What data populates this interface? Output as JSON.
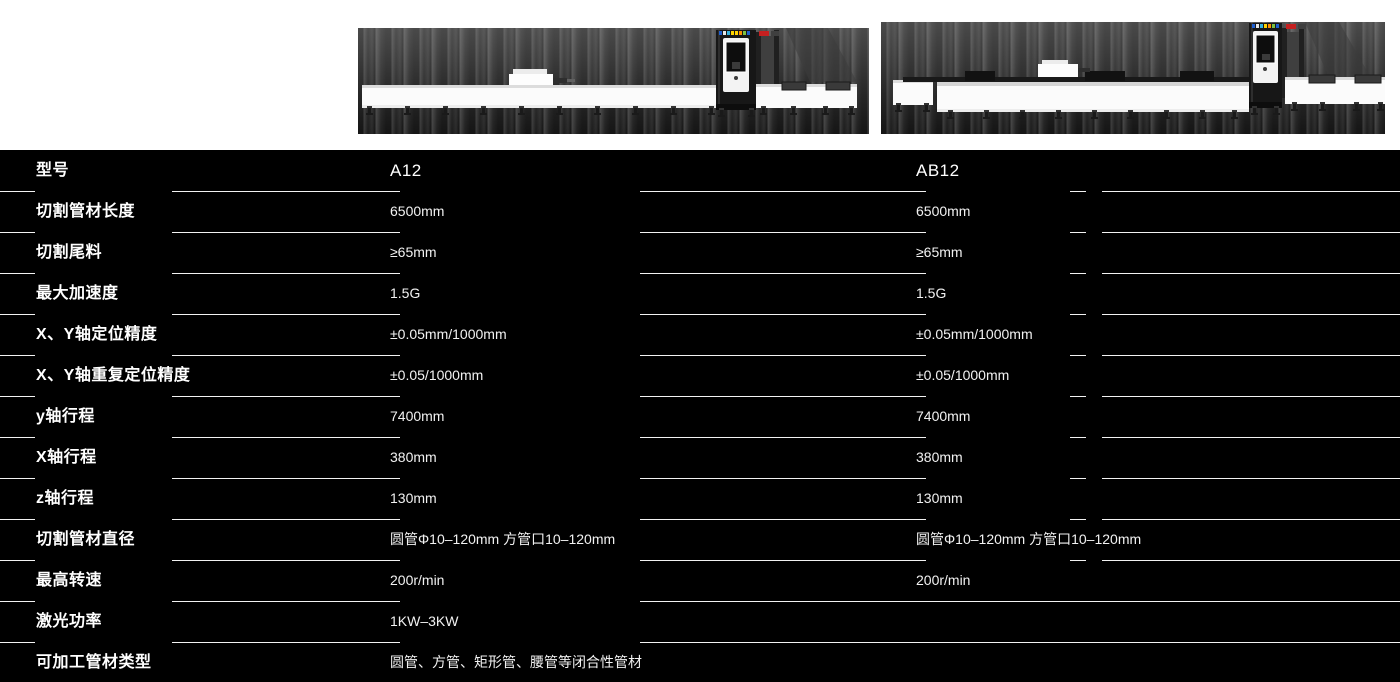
{
  "products": {
    "left_model": "A12",
    "right_model": "AB12"
  },
  "spec_table": {
    "header": {
      "label": "型号",
      "values": [
        "A12",
        "AB12"
      ]
    },
    "rows": [
      {
        "label": "切割管材长度",
        "values": [
          "6500mm",
          "6500mm"
        ]
      },
      {
        "label": "切割尾料",
        "values": [
          "≥65mm",
          "≥65mm"
        ]
      },
      {
        "label": "最大加速度",
        "values": [
          "1.5G",
          "1.5G"
        ]
      },
      {
        "label": "X、Y轴定位精度",
        "values": [
          "±0.05mm/1000mm",
          "±0.05mm/1000mm"
        ]
      },
      {
        "label": "X、Y轴重复定位精度",
        "values": [
          "±0.05/1000mm",
          "±0.05/1000mm"
        ]
      },
      {
        "label": "y轴行程",
        "values": [
          "7400mm",
          "7400mm"
        ]
      },
      {
        "label": "X轴行程",
        "values": [
          "380mm",
          "380mm"
        ]
      },
      {
        "label": "z轴行程",
        "values": [
          "130mm",
          "130mm"
        ]
      },
      {
        "label": "切割管材直径",
        "values": [
          "圆管Φ10–120mm 方管口10–120mm",
          "圆管Φ10–120mm 方管口10–120mm"
        ]
      },
      {
        "label": "最高转速",
        "values": [
          "200r/min",
          "200r/min"
        ]
      },
      {
        "label": "激光功率",
        "values": [
          "1KW–3KW",
          ""
        ]
      },
      {
        "label": "可加工管材类型",
        "values": [
          "圆管、方管、矩形管、腰管等闭合性管材",
          ""
        ]
      }
    ]
  },
  "colors": {
    "table_background": "#000000",
    "divider": "#ffffff",
    "text": "#ffffff",
    "brand_red": "#c42020",
    "machine_body": "#fbfbfb",
    "machine_dark": "#171717"
  }
}
